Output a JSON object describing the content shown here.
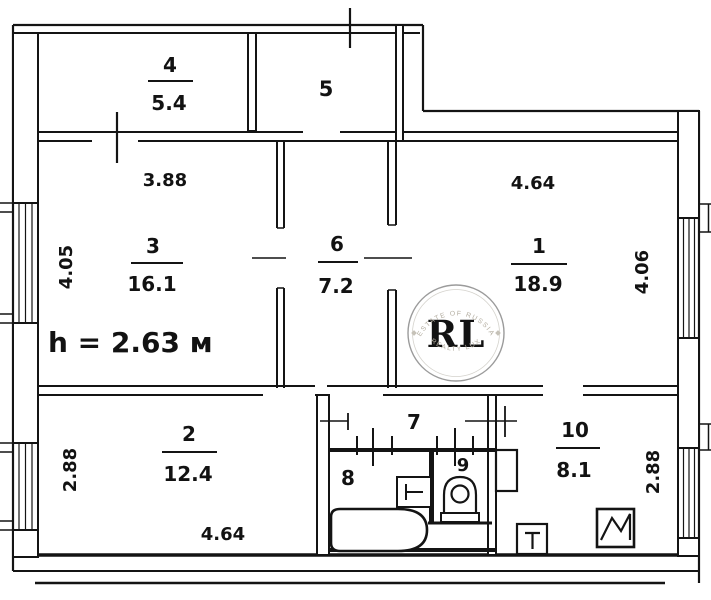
{
  "plan": {
    "note": "h = 2.63 м",
    "rooms": {
      "r1": {
        "number": "1",
        "area": "18.9",
        "dim_top": "4.64",
        "dim_right": "4.06"
      },
      "r2": {
        "number": "2",
        "area": "12.4",
        "dim_left": "2.88",
        "dim_bottom": "4.64"
      },
      "r3": {
        "number": "3",
        "area": "16.1",
        "dim_top": "3.88",
        "dim_left": "4.05"
      },
      "r4": {
        "number": "4",
        "area": "5.4"
      },
      "r5": {
        "number": "5"
      },
      "r6": {
        "number": "6",
        "area": "7.2"
      },
      "r7": {
        "number": "7"
      },
      "r8": {
        "number": "8"
      },
      "r9": {
        "number": "9"
      },
      "r10": {
        "number": "10",
        "area": "8.1",
        "dim_right": "2.88"
      }
    },
    "watermark": {
      "initials": "RL",
      "arc_top": "ESTATE OF RUSSIA",
      "arc_bottom": "REALTY LUX",
      "gold": "#C09A3E",
      "ring": "#9b9b9b"
    },
    "colors": {
      "wall": "#141414",
      "background": "#ffffff"
    }
  }
}
